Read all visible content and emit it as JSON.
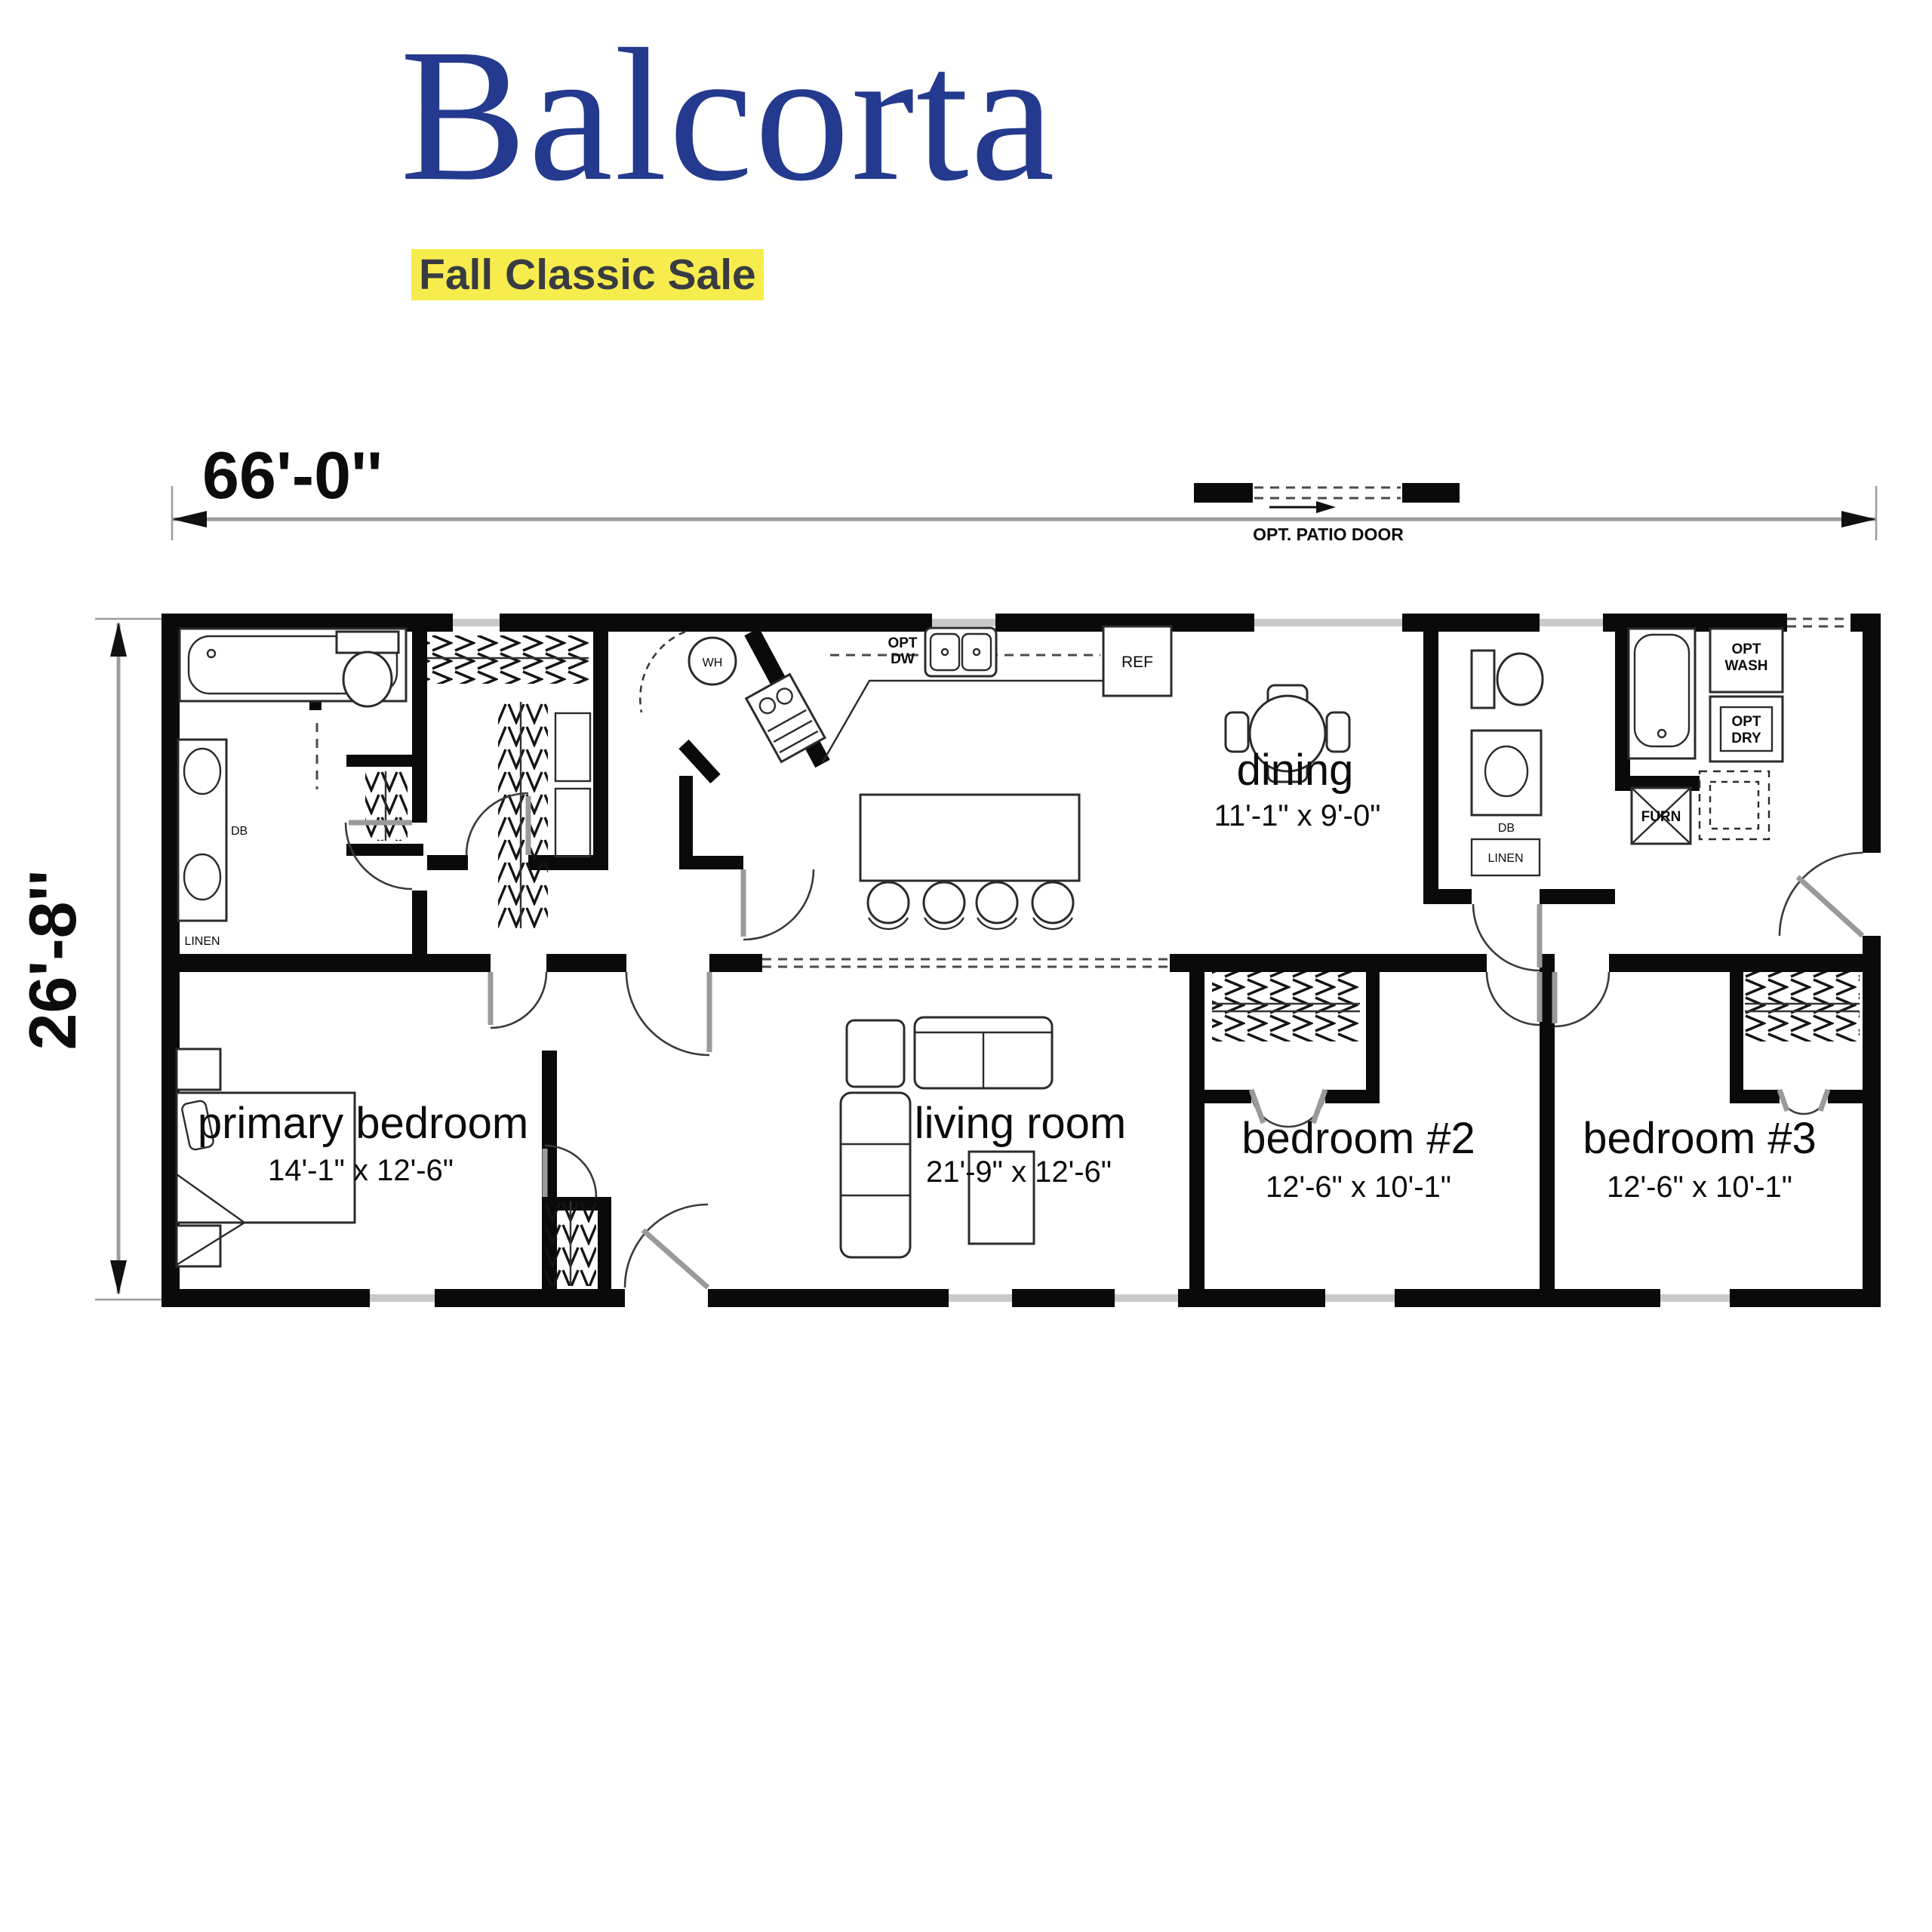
{
  "header": {
    "title": "Balcorta",
    "banner": "Fall Classic Sale",
    "title_color": "#243a8e",
    "banner_bg": "#f7ec4d"
  },
  "dimensions": {
    "width": "66'-0''",
    "height": "26'-8''"
  },
  "annotations": {
    "patio_door": "OPT. PATIO DOOR"
  },
  "rooms": {
    "dining": {
      "name": "dining",
      "size": "11'-1\" x 9'-0\""
    },
    "primary_bedroom": {
      "name": "primary bedroom",
      "size": "14'-1\" x 12'-6\""
    },
    "living_room": {
      "name": "living room",
      "size": "21'-9\" x 12'-6\""
    },
    "bedroom_2": {
      "name": "bedroom #2",
      "size": "12'-6\" x 10'-1\""
    },
    "bedroom_3": {
      "name": "bedroom #3",
      "size": "12'-6\" x 10'-1\""
    }
  },
  "fixtures": {
    "water_heater": "WH",
    "dw1": "OPT",
    "dw2": "DW",
    "refrigerator": "REF",
    "wash1": "OPT",
    "wash2": "WASH",
    "dry1": "OPT",
    "dry2": "DRY",
    "furnace": "FURN",
    "vanity": "DB",
    "linen": "LINEN"
  }
}
